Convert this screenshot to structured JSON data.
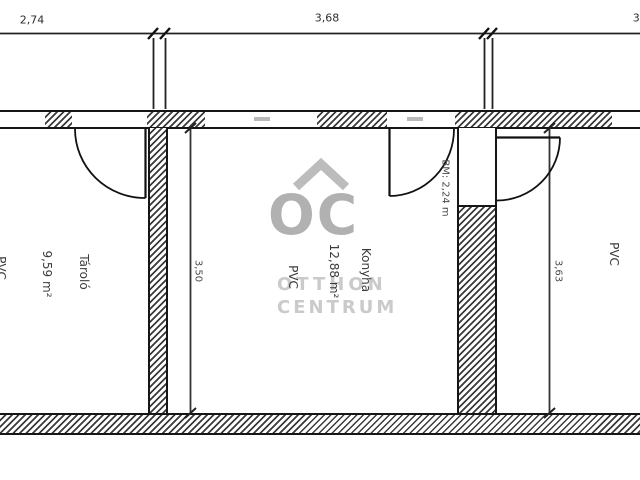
{
  "plan_type": "floor-plan",
  "dimensions": {
    "width_left": "2,74",
    "width_middle": "3,68",
    "width_right_partial": "3,",
    "height_konyha": "3,50",
    "height_right_room": "3,63"
  },
  "rooms": {
    "tarolo": {
      "name": "Tároló",
      "area": "9,59 m²",
      "floor": "PVC"
    },
    "konyha": {
      "name": "Konyha",
      "area": "12,88 m²",
      "floor": "PVC",
      "beam_note": "BM: 2,24 m"
    },
    "right_room": {
      "floor": "PVC"
    }
  },
  "watermark": {
    "logo": "OC",
    "name_line1": "OTTHON",
    "name_line2": "CENTRUM"
  },
  "colors": {
    "line": "#161616",
    "watermark": "#b5b5b5",
    "background": "#ffffff"
  }
}
